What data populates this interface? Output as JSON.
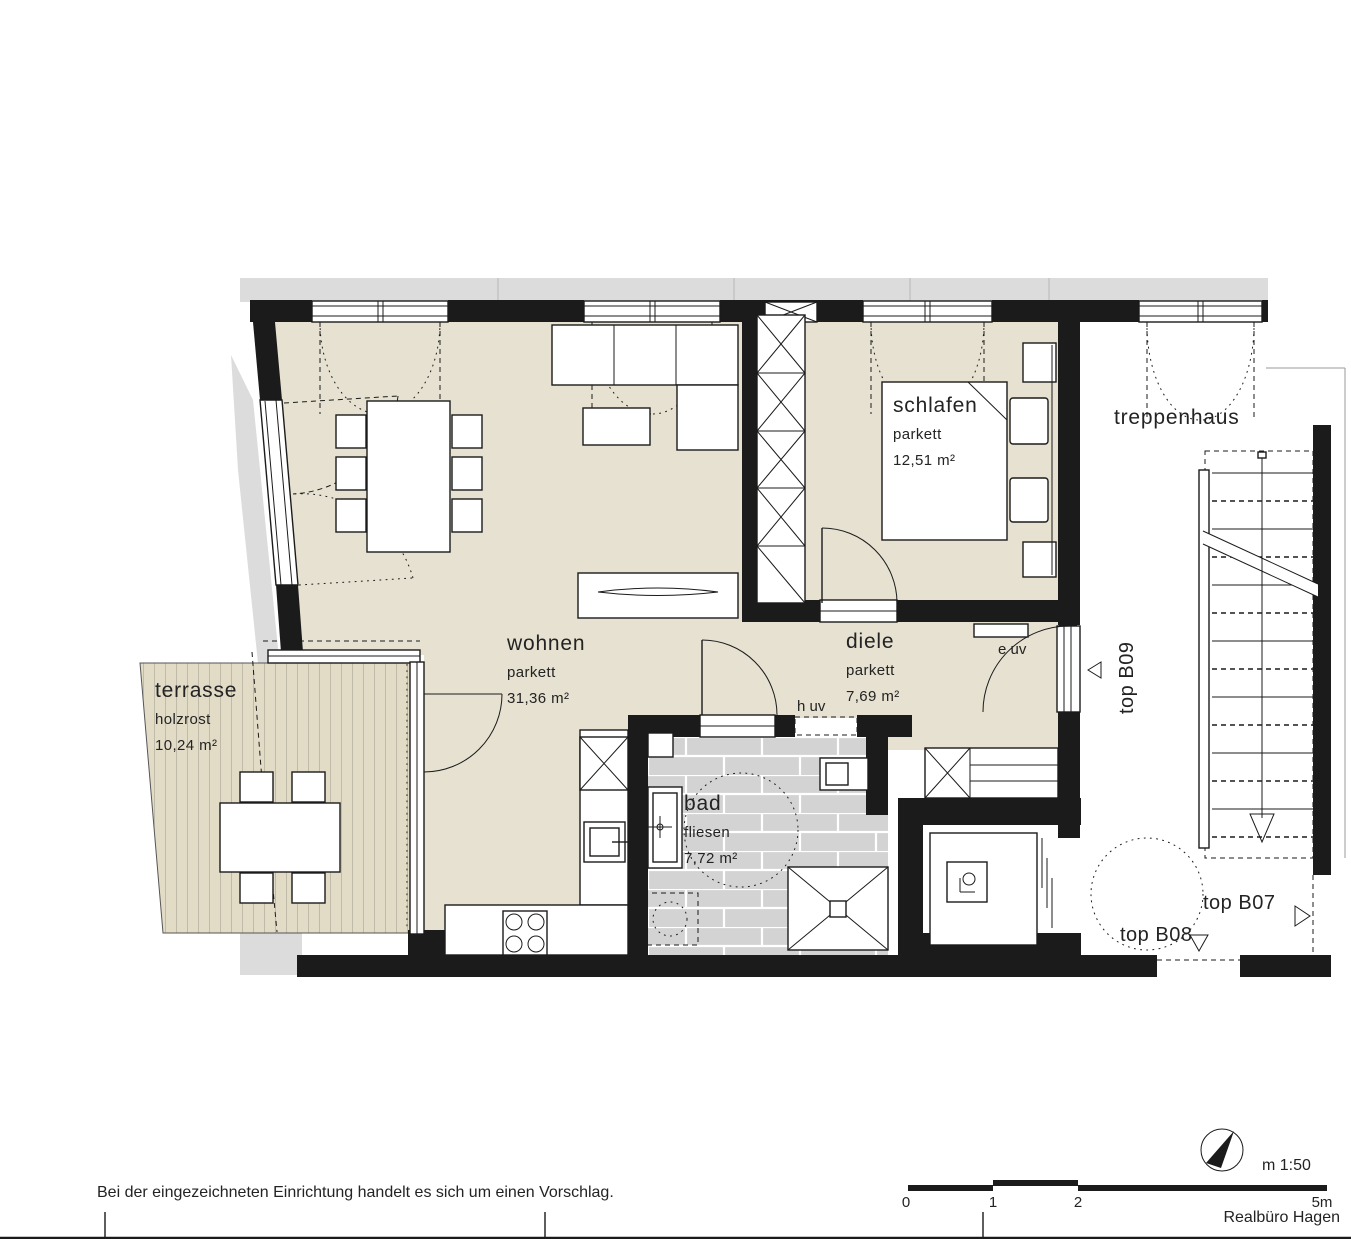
{
  "document": {
    "type": "floor-plan",
    "scale_label": "m 1:50",
    "credit": "Realbüro Hagen",
    "note": "Bei der eingezeichneten Einrichtung handelt es sich um einen Vorschlag."
  },
  "rooms": {
    "wohnen": {
      "name": "wohnen",
      "floor": "parkett",
      "area": "31,36 m²"
    },
    "schlafen": {
      "name": "schlafen",
      "floor": "parkett",
      "area": "12,51 m²"
    },
    "diele": {
      "name": "diele",
      "floor": "parkett",
      "area": "7,69 m²"
    },
    "bad": {
      "name": "bad",
      "floor": "fliesen",
      "area": "7,72 m²"
    },
    "terrasse": {
      "name": "terrasse",
      "floor": "holzrost",
      "area": "10,24 m²"
    },
    "treppenhaus": {
      "name": "treppenhaus"
    }
  },
  "technical": {
    "e_uv": "e uv",
    "h_uv": "h uv"
  },
  "units": {
    "b07": "top B07",
    "b08": "top B08",
    "b09": "top B09"
  },
  "scalebar": {
    "tick0": "0",
    "tick1": "1",
    "tick2": "2",
    "tick5": "5m"
  },
  "colors": {
    "wall": "#1b1b1b",
    "parquet": "#e6e1d0",
    "deck": "#e2dcc7",
    "tile": "#d3d3d3",
    "exterior_band": "#dcdcdc",
    "paper": "#ffffff"
  },
  "icons": {
    "north_arrow": "north-arrow",
    "markers": [
      "triangle-left-icon",
      "triangle-right-icon",
      "triangle-down-icon"
    ]
  }
}
